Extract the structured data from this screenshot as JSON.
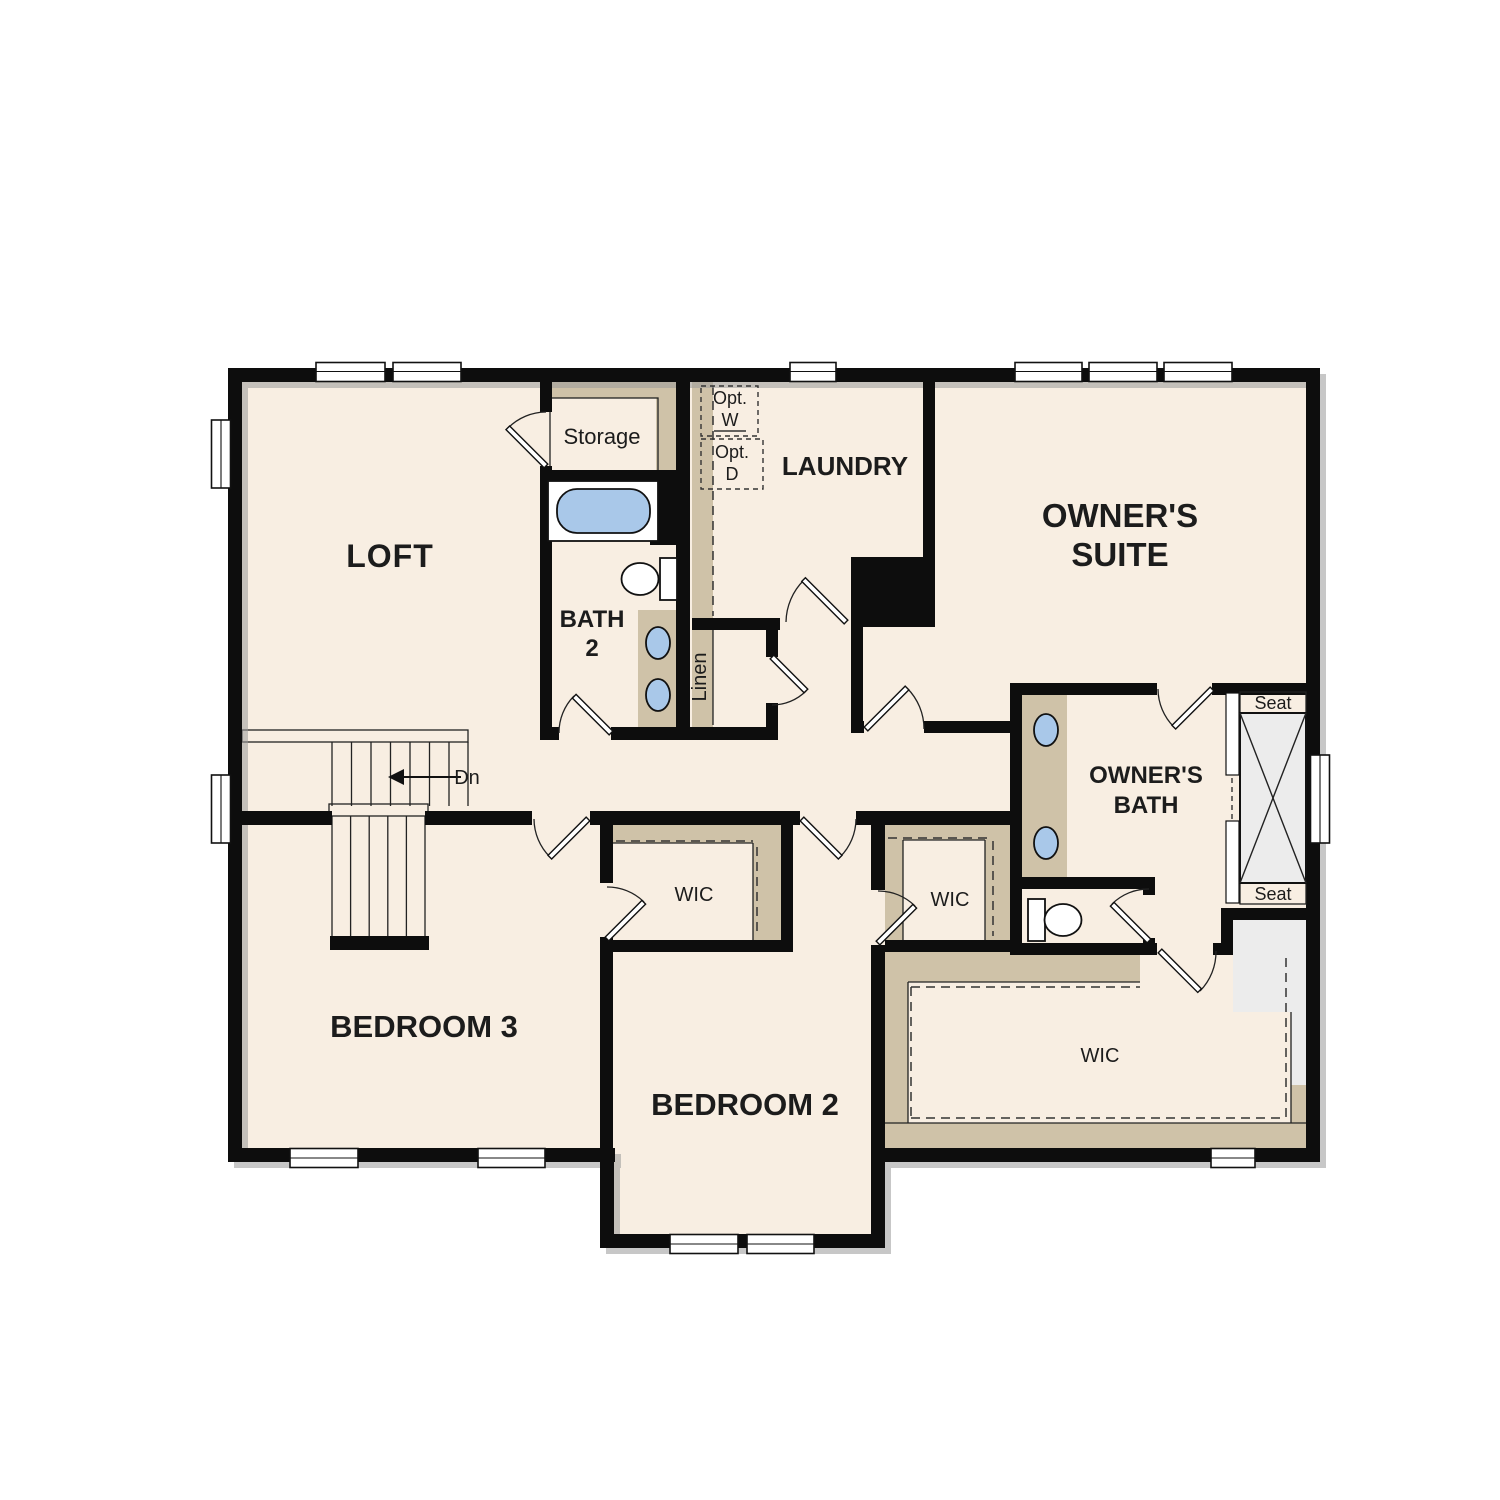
{
  "floor_plan": {
    "rooms": {
      "loft": {
        "label": "LOFT"
      },
      "storage": {
        "label": "Storage"
      },
      "bath_2": {
        "label_line1": "BATH",
        "label_line2": "2"
      },
      "laundry": {
        "label": "LAUNDRY"
      },
      "owners_suite": {
        "label_line1": "OWNER'S",
        "label_line2": "SUITE"
      },
      "owners_bath": {
        "label_line1": "OWNER'S",
        "label_line2": "BATH"
      },
      "linen": {
        "label": "Linen"
      },
      "bedroom_3": {
        "label": "BEDROOM 3"
      },
      "bedroom_2": {
        "label": "BEDROOM 2"
      },
      "wic_bedroom_3": {
        "label": "WIC"
      },
      "wic_bedroom_2": {
        "label": "WIC"
      },
      "wic_owners": {
        "label": "WIC"
      }
    },
    "annotations": {
      "stair_direction": "Dn",
      "optional_washer": {
        "line1": "Opt.",
        "line2": "W"
      },
      "optional_dryer": {
        "line1": "Opt.",
        "line2": "D"
      },
      "shower_seat_top": "Seat",
      "shower_seat_bottom": "Seat"
    },
    "colors": {
      "floor": "#f8eee2",
      "wall": "#0d0d0d",
      "carpet_trim": "#cfc2a8",
      "fixture_blue": "#a9c8e9",
      "tile_gray": "#ececec",
      "background": "#ffffff"
    }
  }
}
